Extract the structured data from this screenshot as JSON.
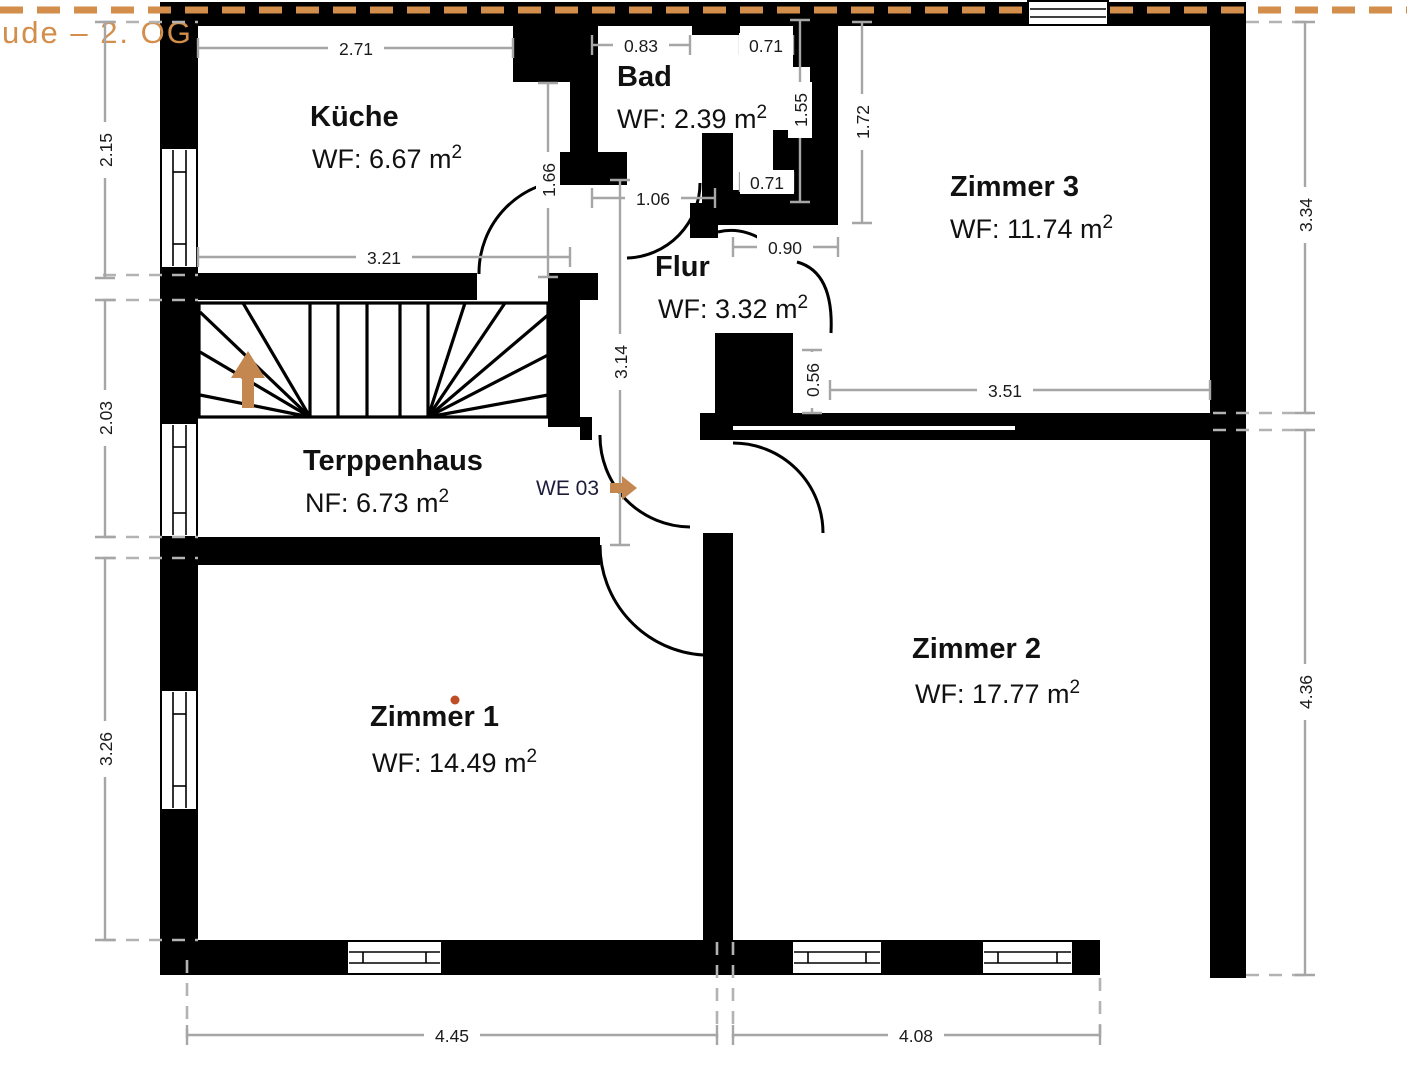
{
  "title": {
    "text": "ude – 2. OG"
  },
  "rooms": {
    "kueche": {
      "name": "Küche",
      "area": "WF: 6.67 m",
      "sup": "2"
    },
    "bad": {
      "name": "Bad",
      "area": "WF: 2.39 m",
      "sup": "2"
    },
    "zimmer3": {
      "name": "Zimmer 3",
      "area": "WF: 11.74 m",
      "sup": "2"
    },
    "flur": {
      "name": "Flur",
      "area": "WF: 3.32 m",
      "sup": "2"
    },
    "treppenhaus": {
      "name": "Terppenhaus",
      "area": "NF: 6.73 m",
      "sup": "2"
    },
    "zimmer1": {
      "name": "Zimmer 1",
      "area": "WF: 14.49 m",
      "sup": "2"
    },
    "zimmer2": {
      "name": "Zimmer 2",
      "area": "WF: 17.77 m",
      "sup": "2"
    }
  },
  "unit": {
    "label": "WE 03"
  },
  "dimensions": {
    "kueche_top": "2.71",
    "kueche_bottom": "3.21",
    "kueche_right": "1.66",
    "bad_top": "0.83",
    "shaft_top": "0.71",
    "shaft_height": "1.55",
    "shaft_bottom": "0.71",
    "bad_door": "1.06",
    "z3_west": "1.72",
    "z3_door": "0.90",
    "z3_bottom": "3.51",
    "z3_notch": "0.56",
    "flur_height": "3.14",
    "left_top": "2.15",
    "left_mid": "2.03",
    "left_bottom": "3.26",
    "right_top": "3.34",
    "right_bottom": "4.36",
    "bottom_left": "4.45",
    "bottom_right": "4.08"
  },
  "colors": {
    "accent": "#d28e4a",
    "arrow": "#c4874f",
    "wall": "#000000",
    "dim_line": "#a6a6a6",
    "marker_dot": "#bf4e24"
  }
}
